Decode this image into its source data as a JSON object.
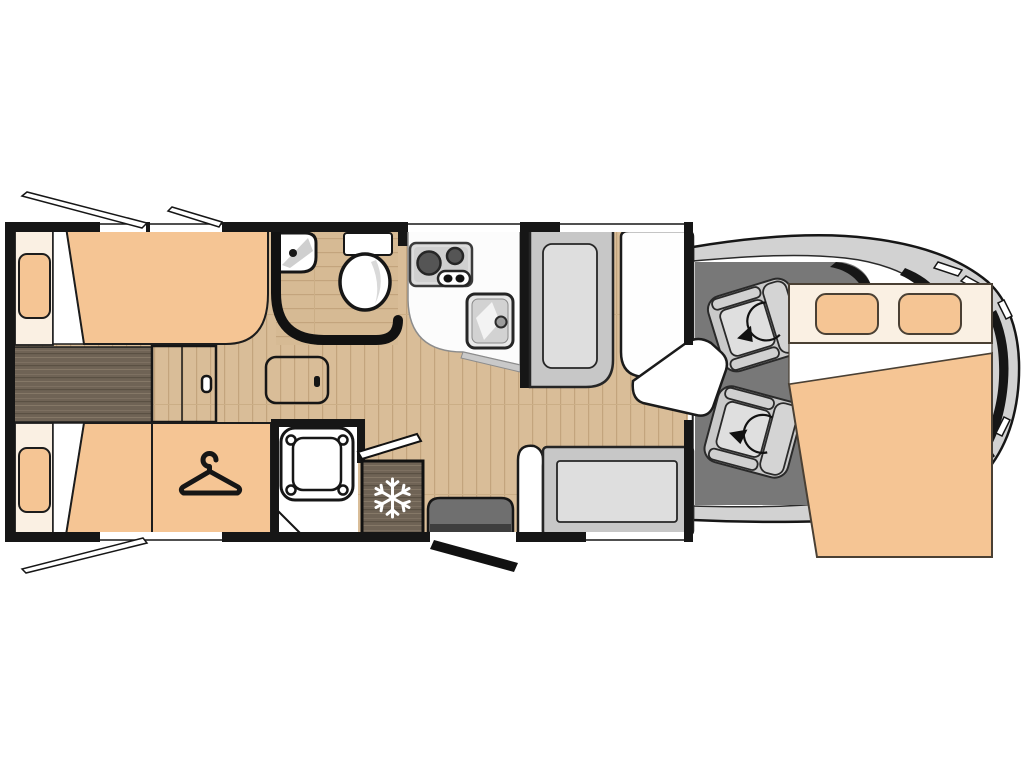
{
  "document": {
    "kind": "motorhome-floor-plan",
    "description": "Top-down floor plan of a coachbuilt motorhome with rear twin single beds, wardrobe, washroom, shower, kitchen, dinette, swivel cab seats and a drop-down double bed over the cab",
    "visible_text": []
  },
  "colors": {
    "wall": "#161616",
    "floor_wood": "#d9bd98",
    "floor_wood_line": "#c3a47d",
    "dark_wood": "#6f6355",
    "upholstery": "#f5c594",
    "bedding_cream": "#faf0e3",
    "cab_floor": "#787878",
    "vehicle_body": "#d2d2d2",
    "seat_gray": "#c9c9c9",
    "seat_cushion": "#dfdfdf",
    "bench_gray": "#c7c7c7",
    "bench_cushion": "#dedede",
    "counter_white": "#fcfcfc",
    "appliance_gray": "#dcdcdc",
    "burner_gray": "#555555",
    "step_gray": "#6f6f6f",
    "white": "#ffffff"
  },
  "rooms": [
    {
      "id": "rear-bedroom",
      "label": "rear twin single beds"
    },
    {
      "id": "wardrobe",
      "label": "wardrobe with hanger symbol"
    },
    {
      "id": "washroom",
      "label": "washroom with corner basin and toilet"
    },
    {
      "id": "shower",
      "label": "separate shower cubicle"
    },
    {
      "id": "kitchen",
      "label": "kitchen with two-burner hob and sink"
    },
    {
      "id": "dinette",
      "label": "dinette with table and two benches"
    },
    {
      "id": "cab",
      "label": "driver cab with two swivel seats"
    },
    {
      "id": "overcab-bed",
      "label": "drop-down double bed over cab"
    }
  ],
  "fixtures": [
    "single-bed-top",
    "single-bed-bottom",
    "bed-pillows",
    "between-bed-step",
    "floor-hatch",
    "wardrobe-hanger",
    "corner-basin",
    "toilet",
    "hob-two-burners",
    "kitchen-sink",
    "fridge-freezer",
    "shower-tray",
    "dinette-table",
    "bench-seat-front",
    "bench-seat-rear",
    "swivel-seat-driver",
    "swivel-seat-passenger",
    "entry-step",
    "entry-door",
    "washroom-door",
    "window-openers",
    "drop-down-double-bed"
  ],
  "icons": [
    {
      "name": "hanger-icon",
      "meaning": "wardrobe"
    },
    {
      "name": "snowflake-icon",
      "meaning": "fridge / freezer"
    },
    {
      "name": "swivel-arrow-icon",
      "meaning": "rotating cab seat"
    }
  ]
}
